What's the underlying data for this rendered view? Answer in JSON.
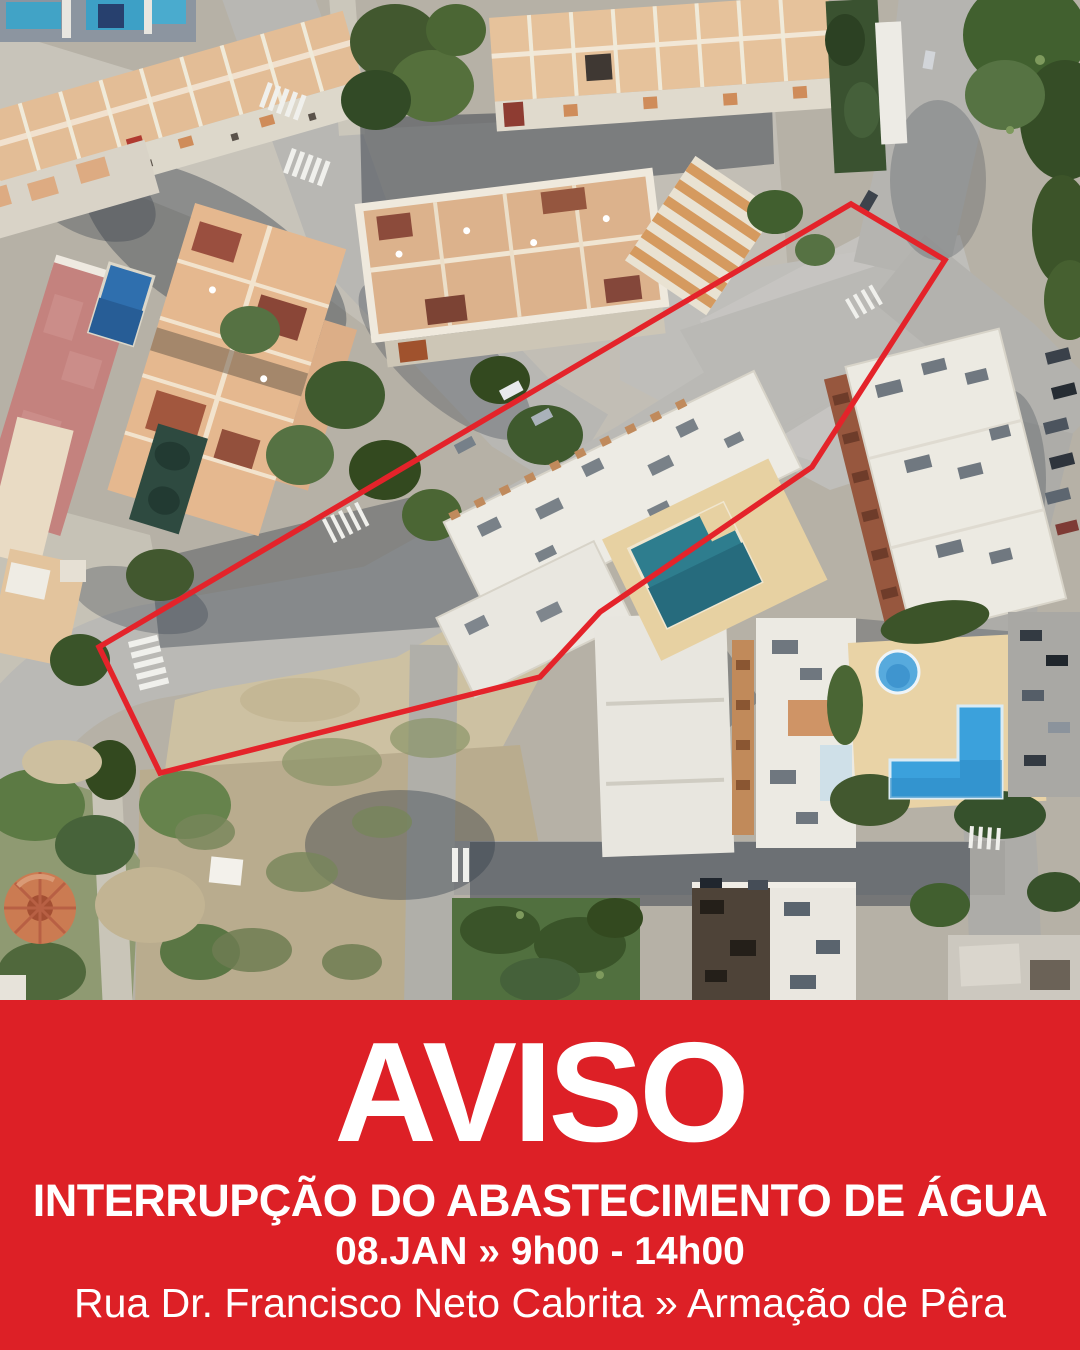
{
  "banner": {
    "title": "AVISO",
    "subtitle": "INTERRUPÇÃO DO ABASTECIMENTO DE ÁGUA",
    "schedule": "08.JAN » 9h00 - 14h00",
    "location": "Rua Dr. Francisco Neto Cabrita » Armação de Pêra",
    "background_color": "#dd2026",
    "text_color": "#ffffff"
  },
  "map": {
    "kind": "aerial-satellite-view",
    "highlight_polygon": {
      "points": "851,204 945,260 812,467 600,612 540,677 160,773 99,647",
      "stroke_color": "#e4232a",
      "stroke_width": "5.5"
    }
  }
}
